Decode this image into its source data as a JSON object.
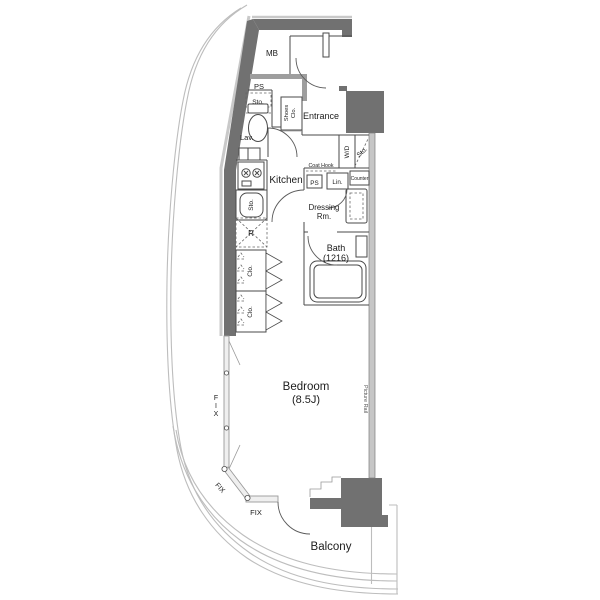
{
  "floorplan": {
    "labels": {
      "mb": "MB",
      "ps_top": "PS",
      "sto_lav": "Sto.",
      "shoes_clo_line1": "Shoes",
      "shoes_clo_line2": "Clo.",
      "entrance": "Entrance",
      "lav": "Lav.",
      "wd": "W/D",
      "sto_wd": "Sto.",
      "coat_hook": "Coat Hook",
      "ps_dressing": "PS",
      "lin": "Lin.",
      "counter": "Counter",
      "kitchen": "Kitchen",
      "sto_kitchen": "Sto.",
      "refrigerator": "R",
      "dressing_line1": "Dressing",
      "dressing_line2": "Rm.",
      "clo_top": "Clo.",
      "clo_bottom": "Clo.",
      "bath_line1": "Bath",
      "bath_line2": "(1216)",
      "bedroom_line1": "Bedroom",
      "bedroom_line2": "(8.5J)",
      "picture_rail": "Picture Rail",
      "fix_window_left": "FIX",
      "fix_window_diagonal": "FIX",
      "fix_window_bottom": "FIX",
      "balcony": "Balcony"
    },
    "colors": {
      "wall": "#717171",
      "wall_light": "#c9c9c9",
      "partition": "#4a4a4a",
      "outline": "#bdbdbd",
      "text": "#1c1c1c",
      "background": "#ffffff"
    }
  }
}
